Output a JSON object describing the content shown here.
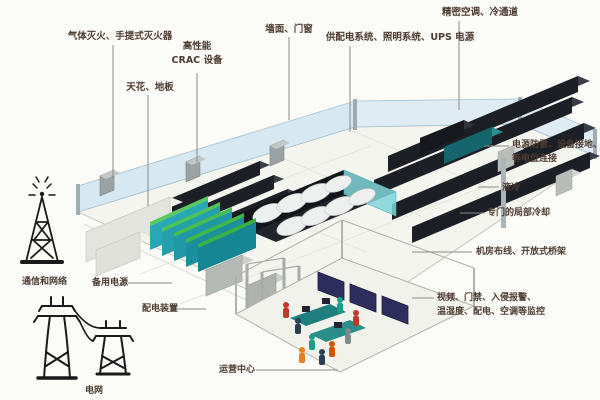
{
  "callouts": {
    "gas_fire_suppression": "气体灭火、手提式灭火器",
    "ceiling_floor": "天花、地板",
    "crac_line1": "高性能",
    "crac_line2": "CRAC 设备",
    "wall_door": "墙面、门窗",
    "power_lighting_ups": "供配电系统、照明系统、UPS 电源",
    "precision_ac_cold_aisle": "精密空调、冷通道",
    "lightning_line1": "电源防雷、设备接地、",
    "lightning_line2": "等电位连接",
    "liquid_cooling": "液冷",
    "dedicated_local_cooling": "专门的局部冷却",
    "cabling_open_tray": "机房布线、开放式桥架",
    "monitoring_line1": "视频、门禁、入侵报警、",
    "monitoring_line2": "温湿度、配电、空调等监控",
    "backup_power": "备用电源",
    "power_distribution": "配电装置",
    "operations_center": "运营中心",
    "comm_network": "通信和网络",
    "power_grid": "电网"
  },
  "icons": {
    "comm_tower": "communication-tower-icon",
    "power_pylons": "power-grid-pylon-icon"
  },
  "colors": {
    "label_text": "#4d3b31",
    "leader_line": "#8a8a84",
    "glass_wall": "#d2e6ef",
    "floor": "#f5f5f0",
    "rack_dark": "#1d1f26",
    "cooling_teal": "#28a8b4",
    "liquid_cooling_rack": "#15656d",
    "pod_top_white": "#eef0ef",
    "monitor_navy": "#2e2e5e",
    "cabinet_white": "#e3e4de",
    "unit_gray": "#b6bab4"
  }
}
